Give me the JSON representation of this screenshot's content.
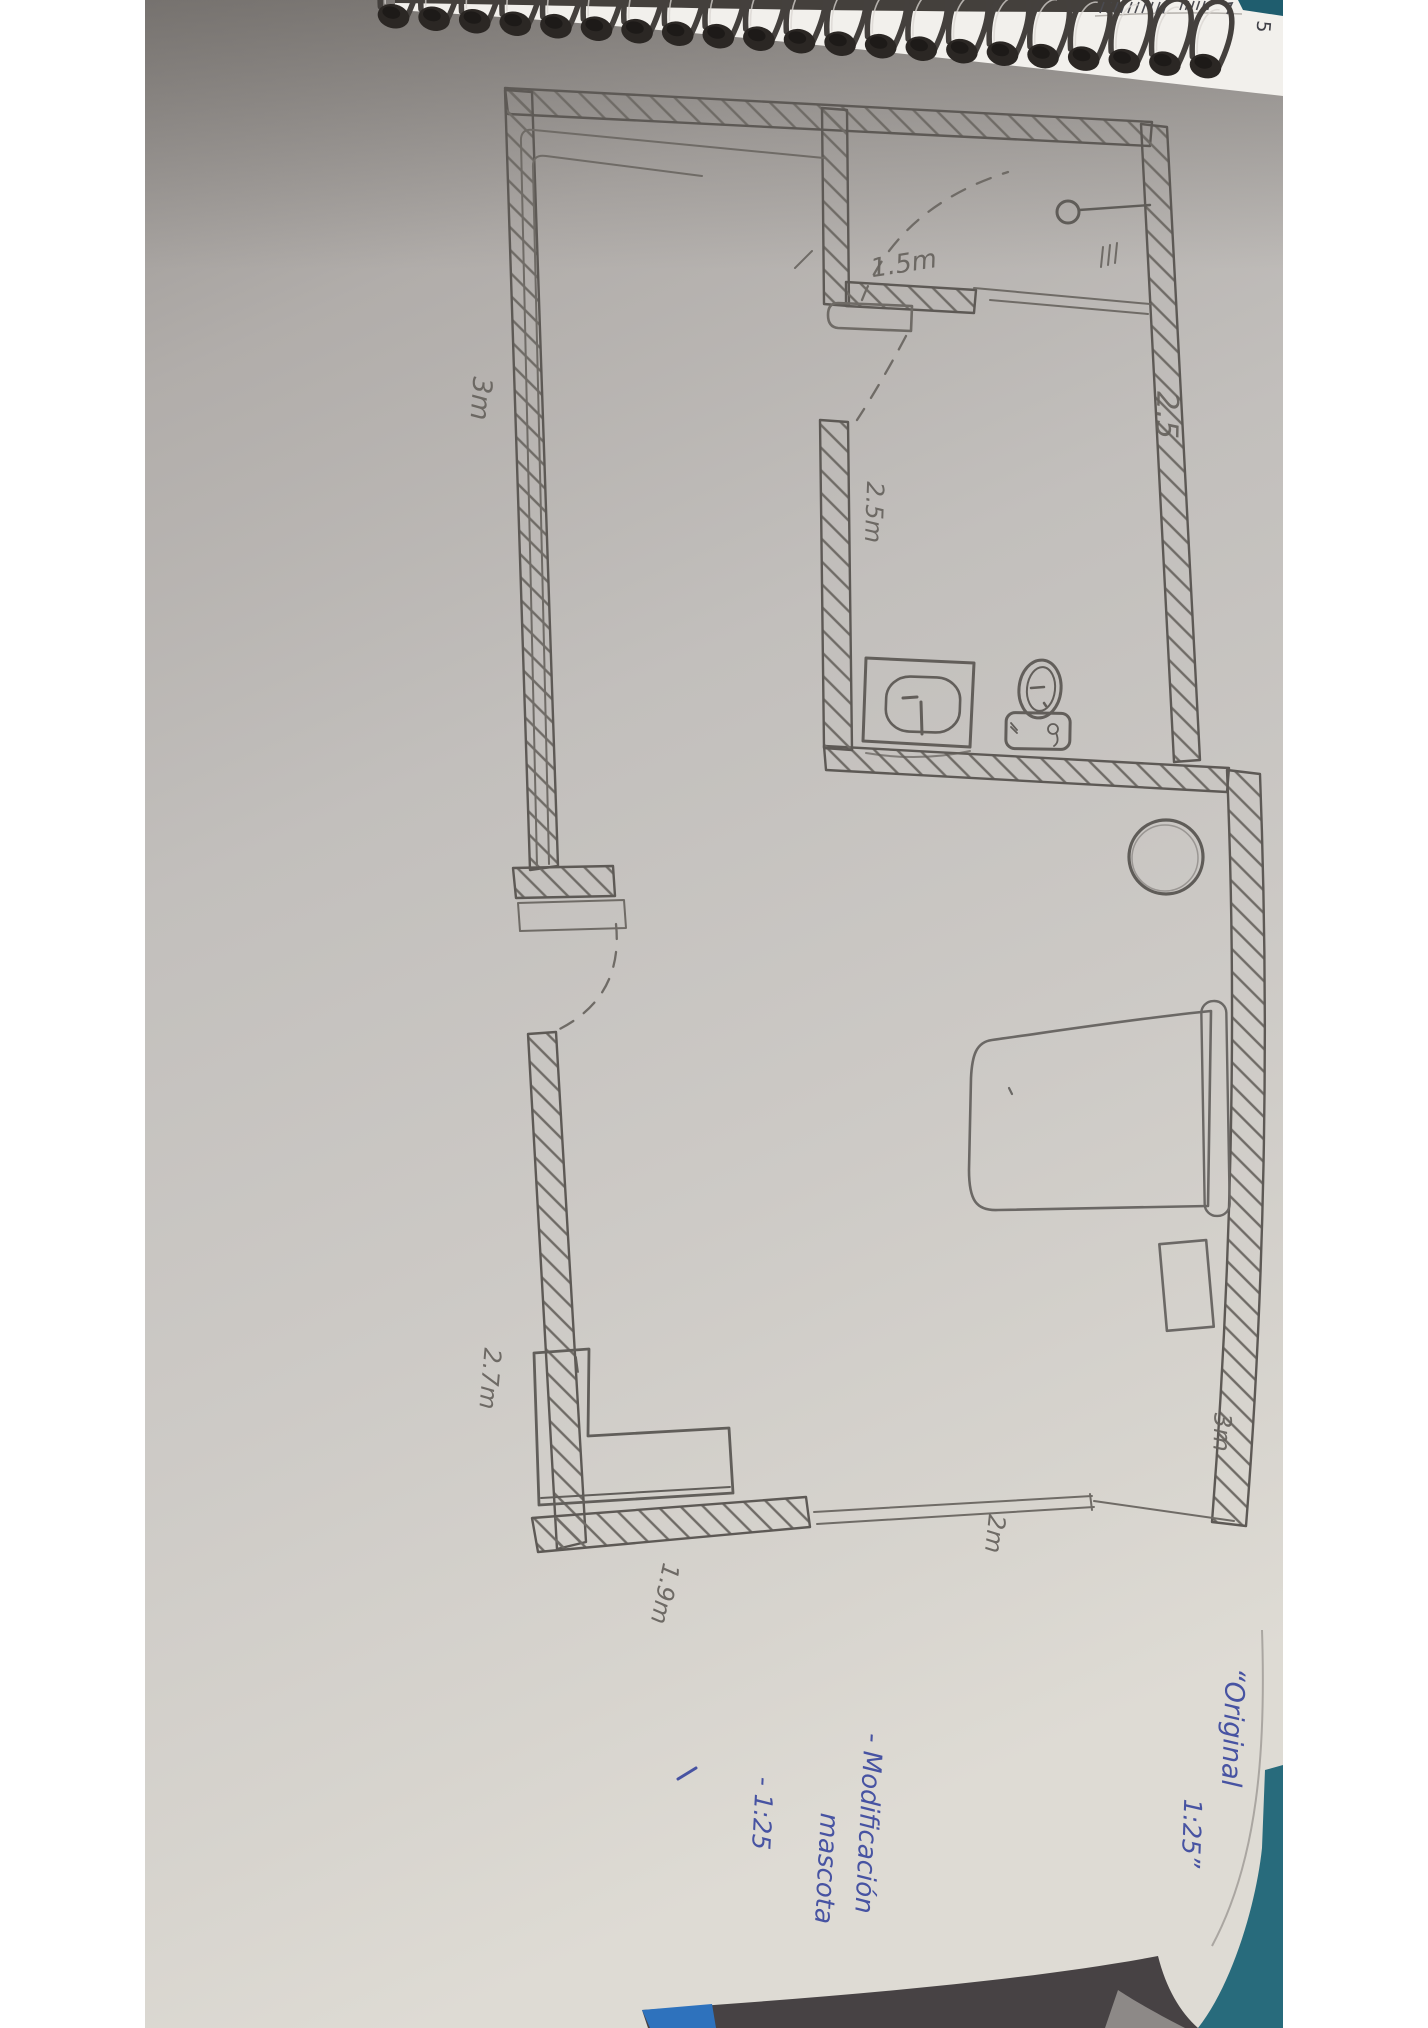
{
  "colors": {
    "paper_top": "#96928f",
    "paper_bottom": "#dedbd4",
    "pencil": "#66625d",
    "wall_stroke": "#5d5955",
    "ink_blue": "#4753a2",
    "couch_teal": "#286b7c",
    "couch_dark": "#474244",
    "couch_light": "#8d8987",
    "notebook_edge_blue": "#2e72bd"
  },
  "notebook": {
    "ruler_digit": "5"
  },
  "floor_plan": {
    "dimensions": {
      "closet_door": "1.5m",
      "top_right_wall": "2.5",
      "bathroom_wall": "2.5m",
      "left_wall": "3m",
      "lower_left_wall": "2.7m",
      "bottom_wall": "1.9m",
      "bottom_window": "2m",
      "right_wall": "3m"
    },
    "annotations": {
      "original_line1": "“Original",
      "original_line2": "1:25”",
      "mod_line1": "- Modificación",
      "mod_line2": "mascota",
      "mod_line3": "- 1:25"
    }
  }
}
